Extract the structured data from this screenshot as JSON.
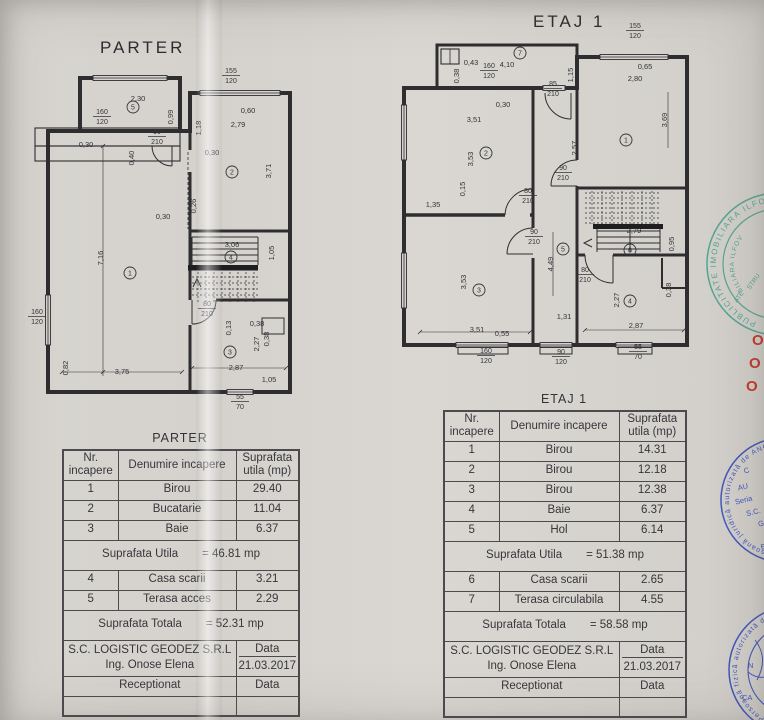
{
  "parter_plan": {
    "title": "PARTER",
    "labels": [
      {
        "t": "2,30",
        "x": 138,
        "y": 101
      },
      {
        "t": "0,60",
        "x": 248,
        "y": 113
      },
      {
        "t": "2,79",
        "x": 238,
        "y": 127
      },
      {
        "t": "0,30",
        "x": 86,
        "y": 147
      },
      {
        "t": "0,30",
        "x": 212,
        "y": 155
      },
      {
        "t": "0,30",
        "x": 163,
        "y": 219
      },
      {
        "t": "3,06",
        "x": 232,
        "y": 247
      },
      {
        "t": "0,38",
        "x": 257,
        "y": 326
      },
      {
        "t": "3,75",
        "x": 122,
        "y": 374
      },
      {
        "t": "2,87",
        "x": 236,
        "y": 370
      },
      {
        "t": "1,05",
        "x": 269,
        "y": 382
      },
      {
        "t": "0,99",
        "x": 173,
        "y": 117,
        "v": 1
      },
      {
        "t": "1,18",
        "x": 201,
        "y": 128,
        "v": 1
      },
      {
        "t": "0,40",
        "x": 134,
        "y": 158,
        "v": 1
      },
      {
        "t": "3,71",
        "x": 271,
        "y": 171,
        "v": 1
      },
      {
        "t": "0,26",
        "x": 196,
        "y": 206,
        "v": 1
      },
      {
        "t": "7,16",
        "x": 103,
        "y": 258,
        "v": 1
      },
      {
        "t": "1,05",
        "x": 274,
        "y": 253,
        "v": 1
      },
      {
        "t": "0,13",
        "x": 231,
        "y": 328,
        "v": 1
      },
      {
        "t": "2,27",
        "x": 259,
        "y": 344,
        "v": 1
      },
      {
        "t": "0,38",
        "x": 269,
        "y": 339,
        "v": 1
      },
      {
        "t": "0,82",
        "x": 68,
        "y": 368,
        "v": 1
      }
    ],
    "fractions": [
      {
        "a": "155",
        "b": "120",
        "x": 231,
        "y": 73
      },
      {
        "a": "160",
        "b": "120",
        "x": 102,
        "y": 114
      },
      {
        "a": "90",
        "b": "210",
        "x": 157,
        "y": 134
      },
      {
        "a": "160",
        "b": "120",
        "x": 37,
        "y": 314
      },
      {
        "a": "80",
        "b": "210",
        "x": 207,
        "y": 306
      },
      {
        "a": "55",
        "b": "70",
        "x": 240,
        "y": 399
      }
    ],
    "rooms": [
      {
        "n": "5",
        "x": 133,
        "y": 107
      },
      {
        "n": "2",
        "x": 232,
        "y": 172
      },
      {
        "n": "1",
        "x": 130,
        "y": 273
      },
      {
        "n": "4",
        "x": 231,
        "y": 257
      },
      {
        "n": "3",
        "x": 230,
        "y": 352
      }
    ]
  },
  "etaj_plan": {
    "title": "ETAJ 1",
    "labels": [
      {
        "t": "0,43",
        "x": 471,
        "y": 65
      },
      {
        "t": "4,10",
        "x": 507,
        "y": 67
      },
      {
        "t": "0,65",
        "x": 645,
        "y": 69
      },
      {
        "t": "2,80",
        "x": 635,
        "y": 81
      },
      {
        "t": "0,30",
        "x": 503,
        "y": 107
      },
      {
        "t": "3,51",
        "x": 474,
        "y": 122
      },
      {
        "t": "1,35",
        "x": 433,
        "y": 207
      },
      {
        "t": "3,51",
        "x": 477,
        "y": 332
      },
      {
        "t": "0,55",
        "x": 502,
        "y": 336
      },
      {
        "t": "2,79",
        "x": 634,
        "y": 233
      },
      {
        "t": "2,87",
        "x": 636,
        "y": 328
      },
      {
        "t": "1,31",
        "x": 564,
        "y": 319
      },
      {
        "t": "0,38",
        "x": 459,
        "y": 76,
        "v": 1
      },
      {
        "t": "1,15",
        "x": 573,
        "y": 75,
        "v": 1
      },
      {
        "t": "3,69",
        "x": 667,
        "y": 120,
        "v": 1
      },
      {
        "t": "2,57",
        "x": 577,
        "y": 148,
        "v": 1
      },
      {
        "t": "3,53",
        "x": 473,
        "y": 159,
        "v": 1
      },
      {
        "t": "0,15",
        "x": 465,
        "y": 189,
        "v": 1
      },
      {
        "t": "3,53",
        "x": 466,
        "y": 282,
        "v": 1
      },
      {
        "t": "4,49",
        "x": 553,
        "y": 264,
        "v": 1
      },
      {
        "t": "0,95",
        "x": 674,
        "y": 244,
        "v": 1
      },
      {
        "t": "2,27",
        "x": 619,
        "y": 300,
        "v": 1
      },
      {
        "t": "0,38",
        "x": 671,
        "y": 290,
        "v": 1
      }
    ],
    "fractions": [
      {
        "a": "155",
        "b": "120",
        "x": 635,
        "y": 28
      },
      {
        "a": "160",
        "b": "120",
        "x": 489,
        "y": 68
      },
      {
        "a": "85",
        "b": "210",
        "x": 553,
        "y": 86
      },
      {
        "a": "90",
        "b": "210",
        "x": 563,
        "y": 170
      },
      {
        "a": "80",
        "b": "210",
        "x": 528,
        "y": 193
      },
      {
        "a": "90",
        "b": "210",
        "x": 534,
        "y": 234
      },
      {
        "a": "80",
        "b": "210",
        "x": 585,
        "y": 272
      },
      {
        "a": "160",
        "b": "120",
        "x": 486,
        "y": 353
      },
      {
        "a": "90",
        "b": "120",
        "x": 561,
        "y": 354
      },
      {
        "a": "55",
        "b": "70",
        "x": 638,
        "y": 349
      }
    ],
    "rooms": [
      {
        "n": "7",
        "x": 520,
        "y": 53
      },
      {
        "n": "1",
        "x": 626,
        "y": 140
      },
      {
        "n": "2",
        "x": 486,
        "y": 153
      },
      {
        "n": "3",
        "x": 479,
        "y": 290
      },
      {
        "n": "5",
        "x": 563,
        "y": 249
      },
      {
        "n": "6",
        "x": 630,
        "y": 250
      },
      {
        "n": "4",
        "x": 630,
        "y": 301
      }
    ]
  },
  "parter_table": {
    "title": "PARTER",
    "header": {
      "col1a": "Nr.",
      "col1b": "incapere",
      "col2": "Denumire incapere",
      "col3a": "Suprafata",
      "col3b": "utila (mp)"
    },
    "rows": [
      [
        "1",
        "Birou",
        "29.40"
      ],
      [
        "2",
        "Bucatarie",
        "11.04"
      ],
      [
        "3",
        "Baie",
        "6.37"
      ]
    ],
    "utila": {
      "label": "Suprafata Utila",
      "value": "= 46.81 mp"
    },
    "rows2": [
      [
        "4",
        "Casa scarii",
        "3.21"
      ],
      [
        "5",
        "Terasa acces",
        "2.29"
      ]
    ],
    "totala": {
      "label": "Suprafata Totala",
      "value": "= 52.31 mp"
    },
    "firm": "S.C. LOGISTIC GEODEZ S.R.L",
    "engineer": "Ing. Onose Elena",
    "data_label": "Data",
    "date": "21.03.2017",
    "receptionat": "Receptionat",
    "data_label2": "Data"
  },
  "etaj_table": {
    "title": "ETAJ 1",
    "header": {
      "col1a": "Nr.",
      "col1b": "incapere",
      "col2": "Denumire incapere",
      "col3a": "Suprafata",
      "col3b": "utila (mp)"
    },
    "rows": [
      [
        "1",
        "Birou",
        "14.31"
      ],
      [
        "2",
        "Birou",
        "12.18"
      ],
      [
        "3",
        "Birou",
        "12.38"
      ],
      [
        "4",
        "Baie",
        "6.37"
      ],
      [
        "5",
        "Hol",
        "6.14"
      ]
    ],
    "utila": {
      "label": "Suprafata Utila",
      "value": "= 51.38 mp"
    },
    "rows2": [
      [
        "6",
        "Casa scarii",
        "2.65"
      ],
      [
        "7",
        "Terasa circulabila",
        "4.55"
      ]
    ],
    "totala": {
      "label": "Suprafata Totala",
      "value": "= 58.58 mp"
    },
    "firm": "S.C. LOGISTIC GEODEZ S.R.L",
    "engineer": "Ing. Onose Elena",
    "data_label": "Data",
    "date": "21.03.2017",
    "receptionat": "Receptionat",
    "data_label2": "Data"
  },
  "stamps": {
    "teal": {
      "ring_text": "PUBLICITATE IMOBILIARA ILFOV ★ O",
      "inner_ring_text": "BILIARA ILFOV",
      "fragments": [
        "STRU",
        "ATE"
      ],
      "color": "#55a492"
    },
    "blue_firm": {
      "ring_text": "persoană juridică autorizată de ANCPI",
      "lines": [
        "C",
        "AU",
        "Seria",
        "S.C.",
        "G",
        "B"
      ],
      "color": "#4256bd"
    },
    "blue_person": {
      "ring_text": "Persoană fizică autorizată de ANC",
      "lines": [
        "N",
        "CA"
      ],
      "color": "#4256bd"
    },
    "red_marks": [
      "O",
      "O",
      "O"
    ],
    "red_color": "#c23a2c"
  }
}
